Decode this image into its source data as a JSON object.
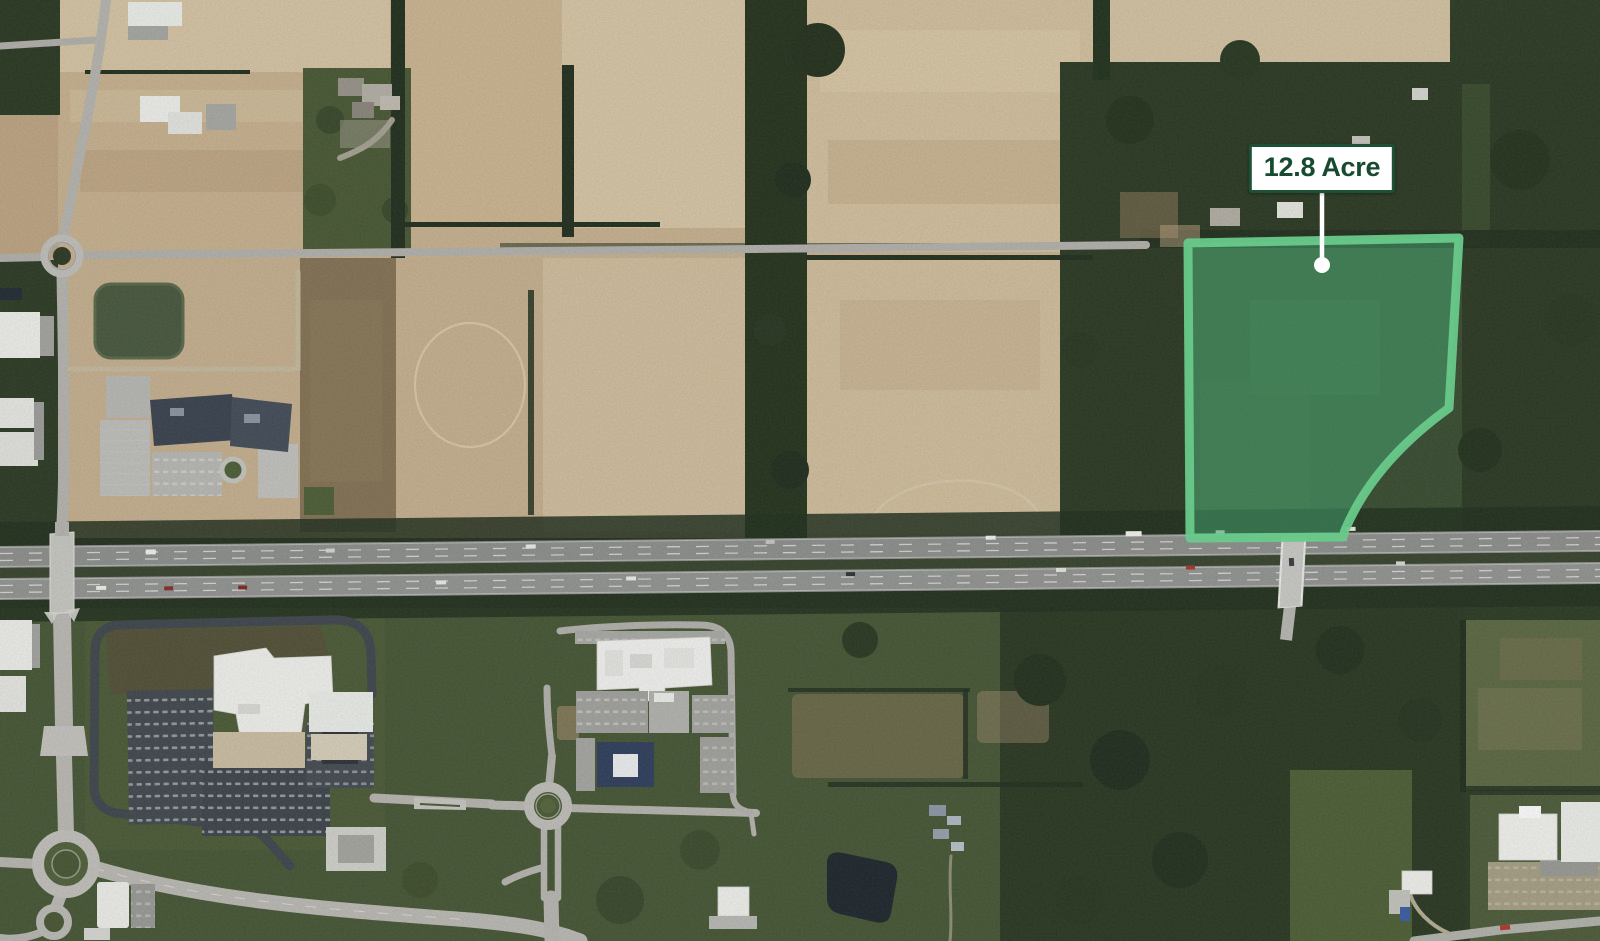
{
  "annotation": {
    "area_label": "12.8 Acre"
  },
  "theme": {
    "label_bg": "#ffffff",
    "label_border": "#1c5136",
    "label_text": "#174a31",
    "parcel_fill": "#46a873",
    "parcel_stroke": "#68c98a",
    "marker": "#ffffff"
  },
  "map": {
    "view_type": "satellite-aerial"
  }
}
